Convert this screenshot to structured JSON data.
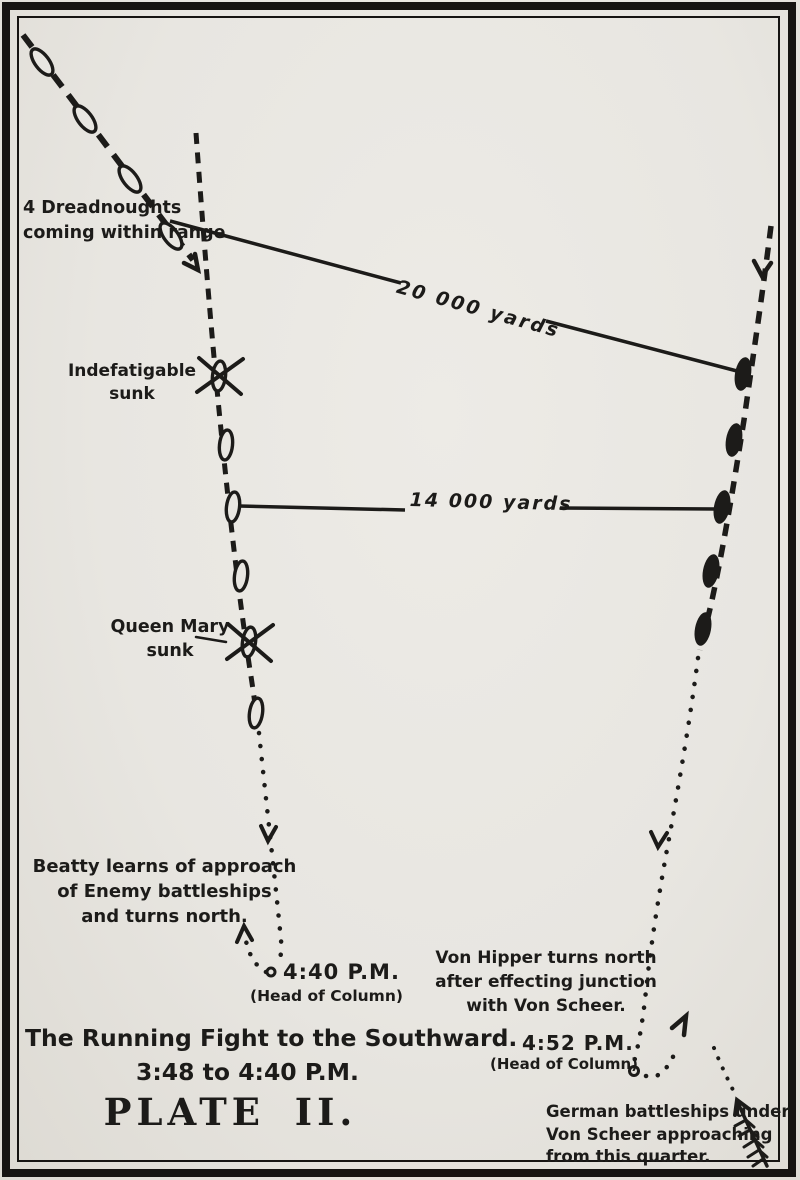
{
  "colors": {
    "ink": "#1c1b19",
    "paper": "#e8e6e1"
  },
  "plate": {
    "title_line1": "The Running Fight to the Southward.",
    "title_line2": "3:48 to 4:40 P.M.",
    "label": "PLATE II."
  },
  "labels": {
    "dreadnoughts": {
      "line1": "4 Dreadnoughts",
      "line2": "coming within range"
    },
    "indefatigable": {
      "line1": "Indefatigable",
      "line2": "sunk"
    },
    "queen_mary": {
      "line1": "Queen Mary",
      "line2": "sunk"
    },
    "beatty": {
      "line1": "Beatty learns of approach",
      "line2": "of Enemy battleships",
      "line3": "and turns north."
    },
    "head_440": {
      "time": "4:40 P.M.",
      "caption": "(Head of Column)"
    },
    "von_hipper": {
      "line1": "Von Hipper turns north",
      "line2": "after effecting junction",
      "line3": "with Von Scheer."
    },
    "head_452": {
      "time": "4:52 P.M.",
      "caption": "(Head of Column)"
    },
    "von_scheer": {
      "line1": "German battleships under",
      "line2": "Von Scheer approaching",
      "line3": "from this quarter."
    },
    "range_20000": "20 000 yards",
    "range_14000": "14 000 yards"
  }
}
